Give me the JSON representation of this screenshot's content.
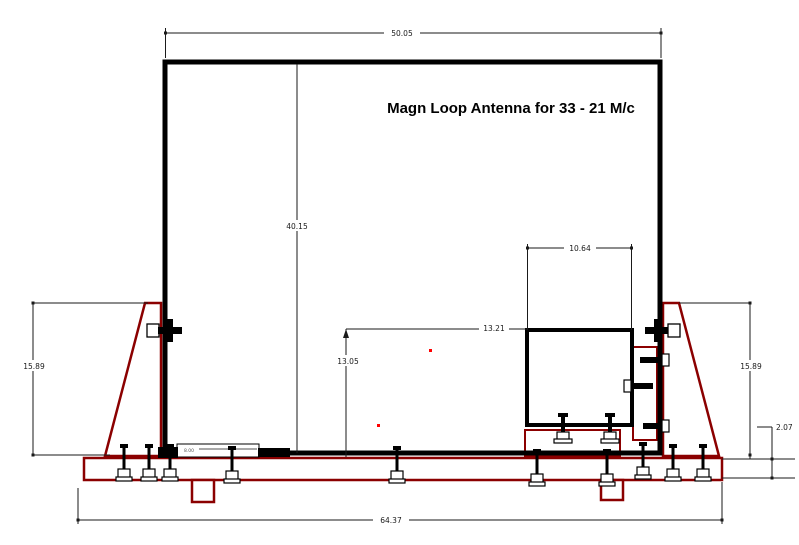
{
  "title": "Magn Loop Antenna for 33 - 21 M/c",
  "dimensions": {
    "top_width": "50.05",
    "loop_height": "40.15",
    "box_width": "10.64",
    "box_top_offset": "13.21",
    "box_base_height": "13.05",
    "left_support_height": "15.89",
    "right_support_height": "15.89",
    "base_thickness": "2.07",
    "base_width": "64.37",
    "small_detail": "8.00"
  },
  "colors": {
    "structure_red": "#8B0000",
    "loop_black": "#000000",
    "marker_red": "#FF0000",
    "background": "#FFFFFF"
  }
}
